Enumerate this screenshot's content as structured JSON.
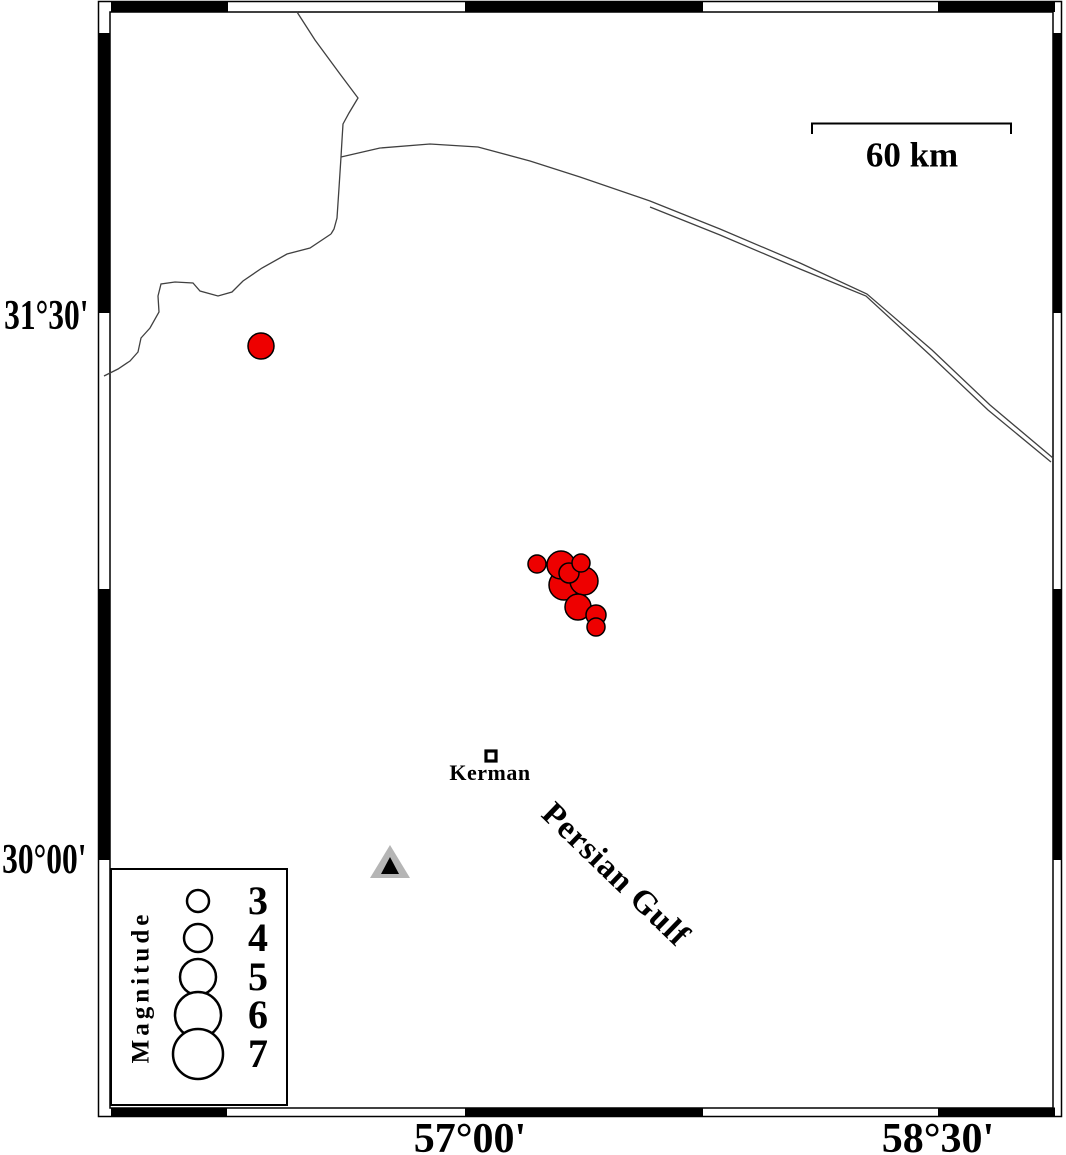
{
  "map": {
    "lat_tick_labels": [
      "31°30'",
      "30°00'"
    ],
    "lon_tick_labels": [
      "57°00'",
      "58°30'"
    ],
    "scale_bar_label": "60 km",
    "city_label": "Kerman",
    "water_body_label": "Persian Gulf",
    "colors": {
      "earthquake_fill": "#ee0000",
      "marker_stroke": "#000000",
      "station_outer": "#b5b5b5",
      "station_inner": "#000000",
      "boundary_line": "#404040",
      "frame": "#000000"
    },
    "city_marker_px": {
      "x": 491,
      "y": 756,
      "size": 10
    },
    "station_px": {
      "outer_points": "390,845 370,878 410,878",
      "inner_points": "390,857 381,874 399,874"
    },
    "earthquakes_px": [
      {
        "x": 261,
        "y": 346,
        "r": 13
      },
      {
        "x": 564,
        "y": 585,
        "r": 15
      },
      {
        "x": 561,
        "y": 565,
        "r": 14
      },
      {
        "x": 584,
        "y": 581,
        "r": 14
      },
      {
        "x": 578,
        "y": 607,
        "r": 13
      },
      {
        "x": 569,
        "y": 573,
        "r": 10
      },
      {
        "x": 596,
        "y": 615,
        "r": 10
      },
      {
        "x": 537,
        "y": 564,
        "r": 9
      },
      {
        "x": 581,
        "y": 563,
        "r": 9
      },
      {
        "x": 596,
        "y": 627,
        "r": 9
      }
    ],
    "boundary_lines_px": [
      {
        "name": "border-line-north",
        "points": "297,12 315,40 340,74 358,98 349,113 343,124 342,140 341,157 339,188 337,218 334,229 331,234"
      },
      {
        "name": "border-line-southwest",
        "points": "331,234 310,248 287,254 262,268 243,281 232,292 218,296 200,291 193,283 175,282 161,284 158,296 159,312 150,328 141,338 138,352 130,361 118,369 104,376"
      },
      {
        "name": "road-line-east-1",
        "points": "341,157 380,148 430,144 478,147 530,161 580,177 650,201 720,229 800,263 867,294 932,350 990,405 1053,458"
      },
      {
        "name": "road-line-east-2",
        "points": "650,207 720,235 800,269 866,296 930,355 988,410 1051,462"
      }
    ]
  },
  "legend": {
    "title": "Magnitude",
    "entries": [
      {
        "label": "3",
        "radius_px": 11
      },
      {
        "label": "4",
        "radius_px": 14
      },
      {
        "label": "5",
        "radius_px": 18
      },
      {
        "label": "6",
        "radius_px": 23
      },
      {
        "label": "7",
        "radius_px": 25
      }
    ]
  }
}
